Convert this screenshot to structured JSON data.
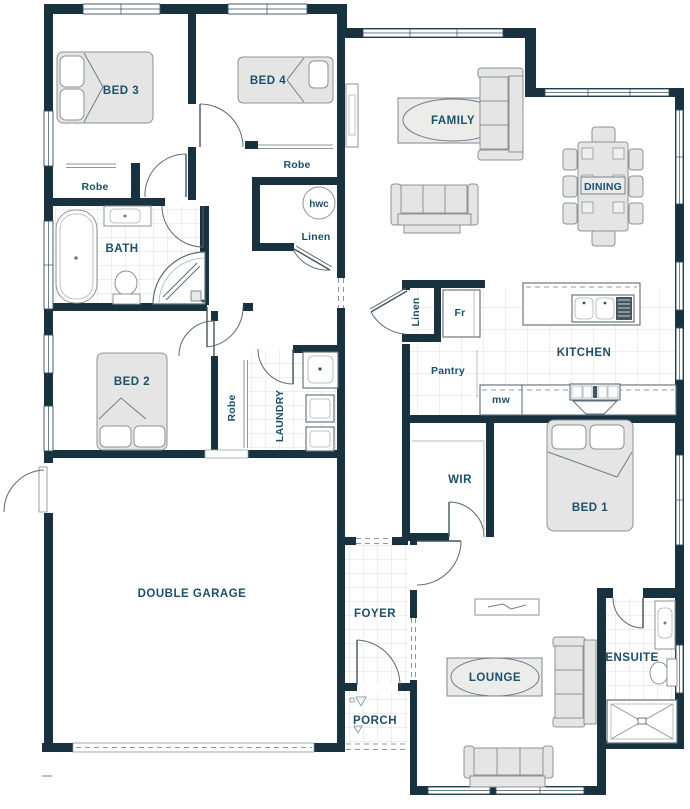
{
  "plan_title": "Single storey house floor plan",
  "colors": {
    "wall": "#18323f",
    "label_text": "#1d5068",
    "furniture_fill": "#e4e5e4",
    "tile_line": "#d9dee0",
    "floor": "#ffffff"
  },
  "rooms": {
    "bed3": "BED 3",
    "bed4": "BED 4",
    "bath": "BATH",
    "bed2": "BED 2",
    "family": "FAMILY",
    "dining": "DINING",
    "kitchen": "KITCHEN",
    "laundry": "LAUNDRY",
    "wir": "WIR",
    "bed1": "BED 1",
    "garage": "DOUBLE GARAGE",
    "foyer": "FOYER",
    "lounge": "LOUNGE",
    "ensuite": "ENSUITE",
    "porch": "PORCH"
  },
  "closets": {
    "robe_bed3": "Robe",
    "robe_bed4": "Robe",
    "robe_bed2": "Robe",
    "linen_hall": "Linen",
    "linen_kitchen": "Linen",
    "hwc": "hwc",
    "fridge": "Fr",
    "pantry": "Pantry",
    "microwave": "mw"
  }
}
